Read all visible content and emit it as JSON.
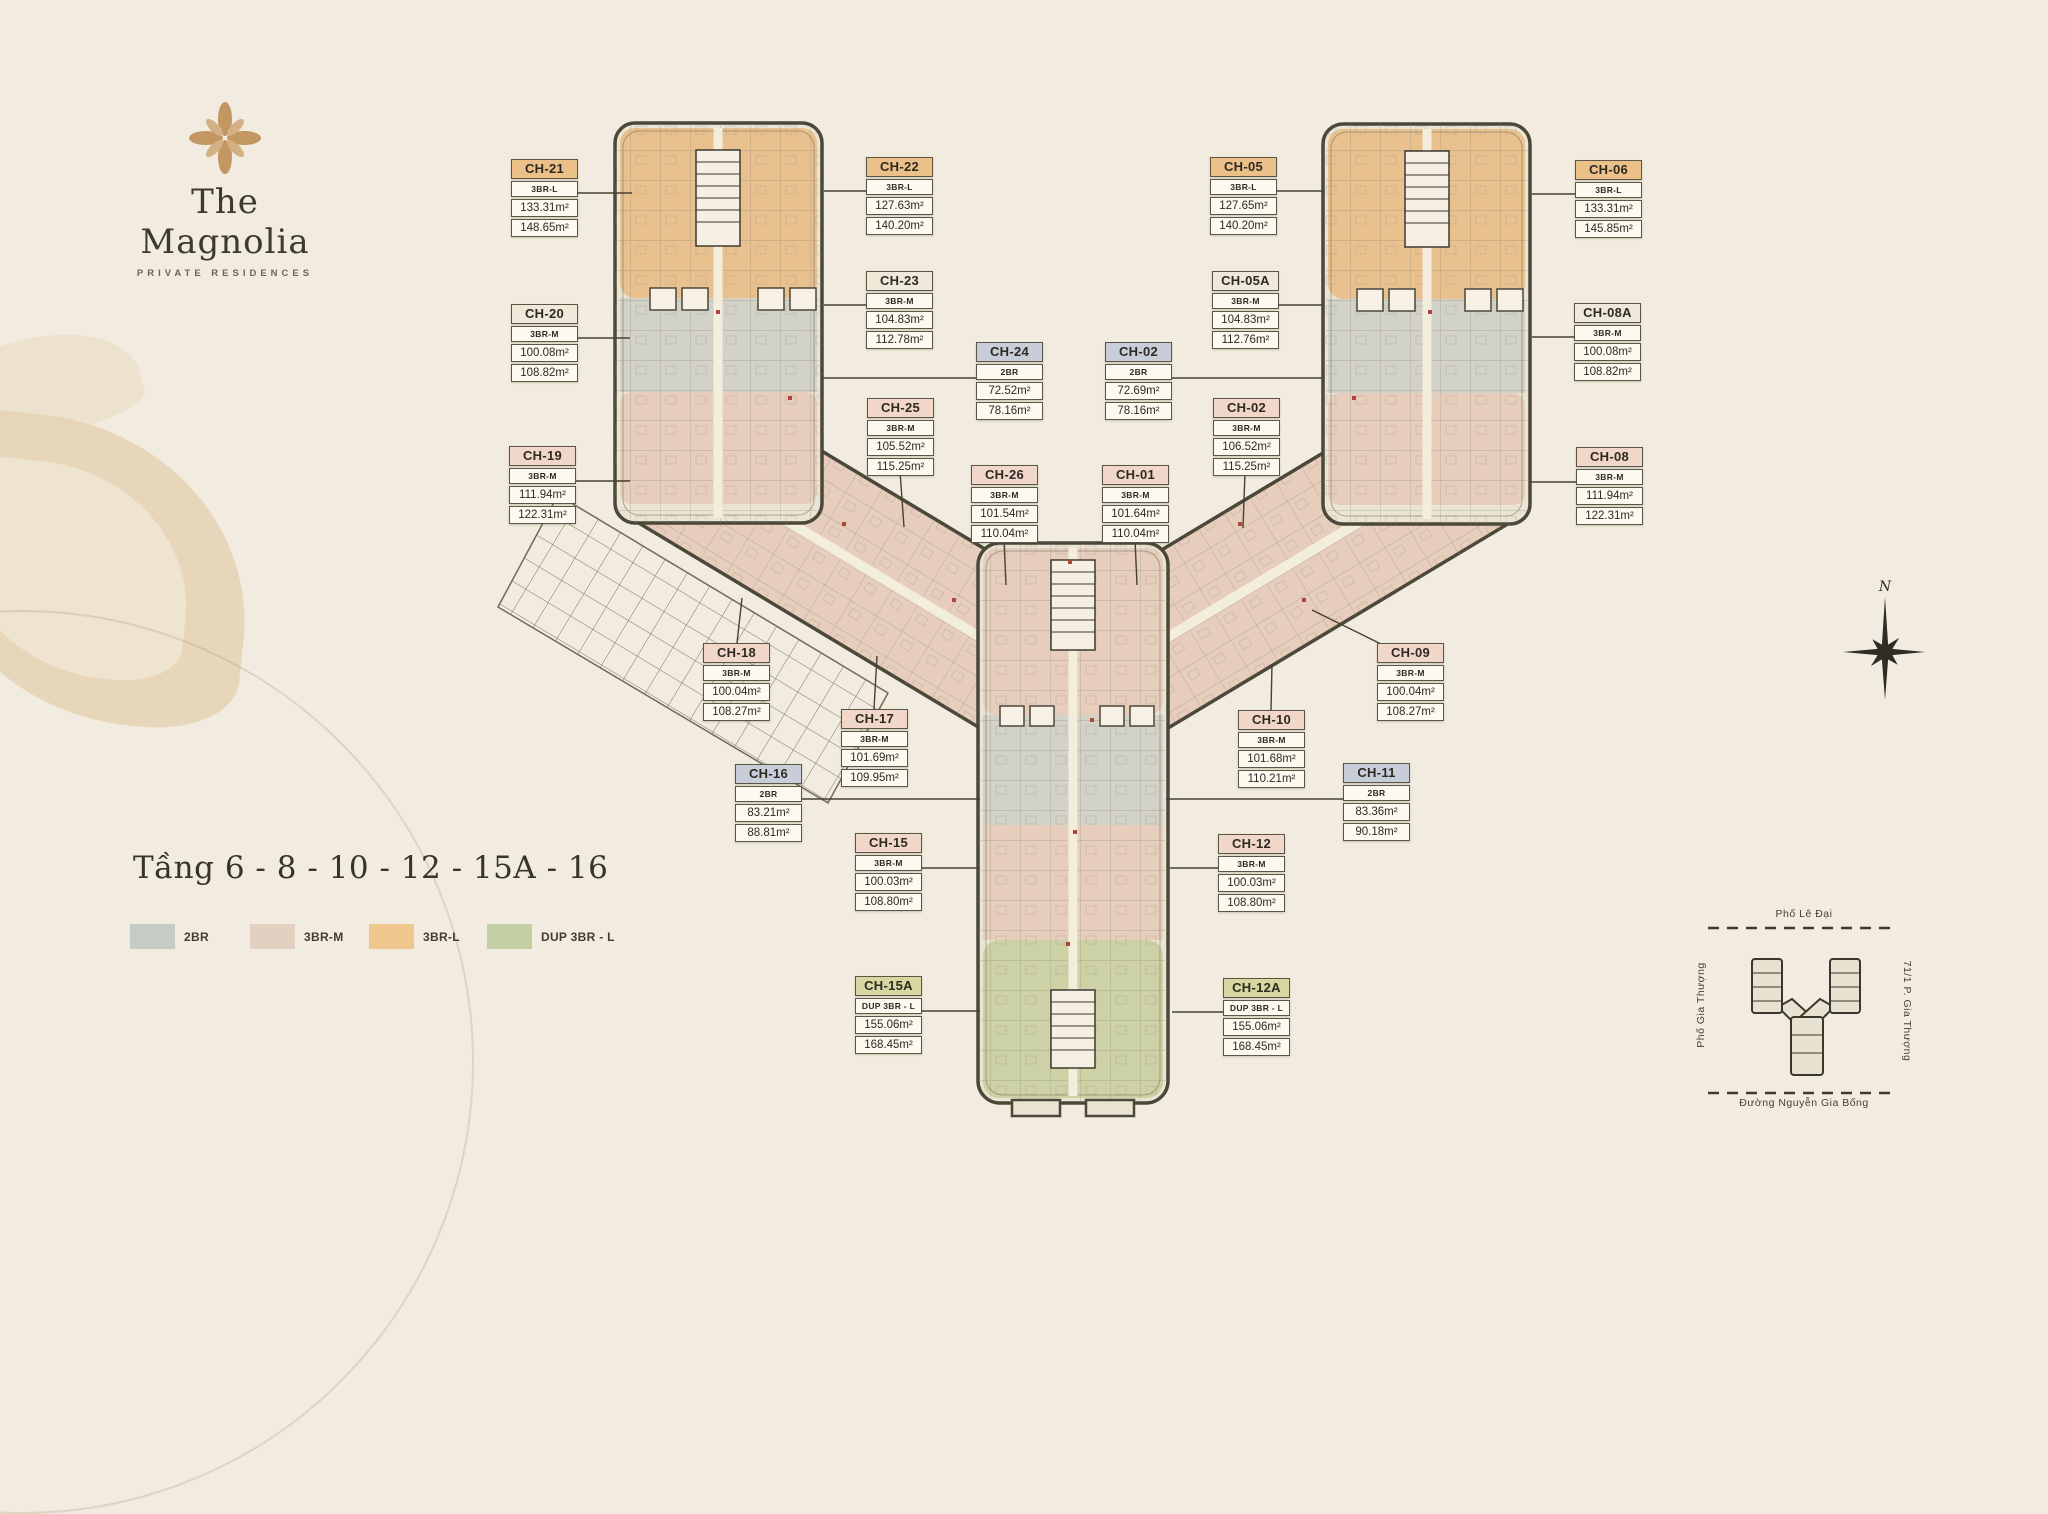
{
  "logo": {
    "icon": "magnolia-flower-icon",
    "title": "The Magnolia",
    "subtitle": "PRIVATE RESIDENCES"
  },
  "floor_title": "Tầng 6 - 8 - 10 - 12 - 15A - 16",
  "legend": [
    {
      "label": "2BR",
      "color": "#c5ccc5"
    },
    {
      "label": "3BR-M",
      "color": "#e3d0c1"
    },
    {
      "label": "3BR-L",
      "color": "#f0c88f"
    },
    {
      "label": "DUP 3BR - L",
      "color": "#c3cfa2"
    }
  ],
  "unit_colors": {
    "orange": "#ecc189",
    "pink": "#f1d7c9",
    "blue": "#c7cdd9",
    "green": "#d6d7a1",
    "neutral": "#efe9da"
  },
  "units": [
    {
      "id": "CH-21",
      "type": "3BR-L",
      "area1": "133.31m²",
      "area2": "148.65m²",
      "color": "orange",
      "x": 511,
      "y": 159,
      "leader": [
        578,
        193,
        632,
        193
      ]
    },
    {
      "id": "CH-20",
      "type": "3BR-M",
      "area1": "100.08m²",
      "area2": "108.82m²",
      "color": "neutral",
      "x": 511,
      "y": 304,
      "leader": [
        578,
        338,
        630,
        338
      ]
    },
    {
      "id": "CH-19",
      "type": "3BR-M",
      "area1": "111.94m²",
      "area2": "122.31m²",
      "color": "pink",
      "x": 509,
      "y": 446,
      "leader": [
        576,
        481,
        630,
        481
      ]
    },
    {
      "id": "CH-18",
      "type": "3BR-M",
      "area1": "100.04m²",
      "area2": "108.27m²",
      "color": "pink",
      "x": 703,
      "y": 643,
      "leader": [
        737,
        643,
        742,
        598
      ]
    },
    {
      "id": "CH-17",
      "type": "3BR-M",
      "area1": "101.69m²",
      "area2": "109.95m²",
      "color": "pink",
      "x": 841,
      "y": 709,
      "leader": [
        874,
        709,
        877,
        656
      ]
    },
    {
      "id": "CH-16",
      "type": "2BR",
      "area1": "83.21m²",
      "area2": "88.81m²",
      "color": "blue",
      "x": 735,
      "y": 764,
      "leader": [
        802,
        799,
        980,
        799
      ]
    },
    {
      "id": "CH-15",
      "type": "3BR-M",
      "area1": "100.03m²",
      "area2": "108.80m²",
      "color": "pink",
      "x": 855,
      "y": 833,
      "leader": [
        922,
        868,
        980,
        868
      ]
    },
    {
      "id": "CH-15A",
      "type": "DUP 3BR - L",
      "area1": "155.06m²",
      "area2": "168.45m²",
      "color": "green",
      "x": 855,
      "y": 976,
      "leader": [
        922,
        1011,
        980,
        1011
      ]
    },
    {
      "id": "CH-22",
      "type": "3BR-L",
      "area1": "127.63m²",
      "area2": "140.20m²",
      "color": "orange",
      "x": 866,
      "y": 157,
      "leader": [
        866,
        191,
        824,
        191
      ]
    },
    {
      "id": "CH-23",
      "type": "3BR-M",
      "area1": "104.83m²",
      "area2": "112.78m²",
      "color": "neutral",
      "x": 866,
      "y": 271,
      "leader": [
        866,
        305,
        824,
        305
      ]
    },
    {
      "id": "CH-24",
      "type": "2BR",
      "area1": "72.52m²",
      "area2": "78.16m²",
      "color": "blue",
      "x": 976,
      "y": 342,
      "leader": [
        976,
        378,
        823,
        378
      ]
    },
    {
      "id": "CH-25",
      "type": "3BR-M",
      "area1": "105.52m²",
      "area2": "115.25m²",
      "color": "pink",
      "x": 867,
      "y": 398,
      "leader": [
        900,
        471,
        904,
        527
      ]
    },
    {
      "id": "CH-26",
      "type": "3BR-M",
      "area1": "101.54m²",
      "area2": "110.04m²",
      "color": "pink",
      "x": 971,
      "y": 465,
      "leader": [
        1004,
        539,
        1006,
        585
      ]
    },
    {
      "id": "CH-02",
      "type": "2BR",
      "area1": "72.69m²",
      "area2": "78.16m²",
      "color": "blue",
      "x": 1105,
      "y": 342,
      "leader": [
        1172,
        378,
        1322,
        378
      ]
    },
    {
      "id": "CH-01",
      "type": "3BR-M",
      "area1": "101.64m²",
      "area2": "110.04m²",
      "color": "pink",
      "x": 1102,
      "y": 465,
      "leader": [
        1135,
        539,
        1137,
        585
      ]
    },
    {
      "id": "CH-05",
      "type": "3BR-L",
      "area1": "127.65m²",
      "area2": "140.20m²",
      "color": "orange",
      "x": 1210,
      "y": 157,
      "leader": [
        1277,
        191,
        1322,
        191
      ]
    },
    {
      "id": "CH-05A",
      "type": "3BR-M",
      "area1": "104.83m²",
      "area2": "112.76m²",
      "color": "neutral",
      "x": 1212,
      "y": 271,
      "leader": [
        1279,
        305,
        1322,
        305
      ]
    },
    {
      "id": "CH-02",
      "type": "3BR-M",
      "area1": "106.52m²",
      "area2": "115.25m²",
      "color": "pink",
      "x": 1213,
      "y": 398,
      "leader": [
        1245,
        472,
        1243,
        528
      ]
    },
    {
      "id": "CH-06",
      "type": "3BR-L",
      "area1": "133.31m²",
      "area2": "145.85m²",
      "color": "orange",
      "x": 1575,
      "y": 160,
      "leader": [
        1575,
        194,
        1532,
        194
      ]
    },
    {
      "id": "CH-08A",
      "type": "3BR-M",
      "area1": "100.08m²",
      "area2": "108.82m²",
      "color": "neutral",
      "x": 1574,
      "y": 303,
      "leader": [
        1574,
        337,
        1532,
        337
      ]
    },
    {
      "id": "CH-08",
      "type": "3BR-M",
      "area1": "111.94m²",
      "area2": "122.31m²",
      "color": "pink",
      "x": 1576,
      "y": 447,
      "leader": [
        1576,
        482,
        1530,
        482
      ]
    },
    {
      "id": "CH-09",
      "type": "3BR-M",
      "area1": "100.04m²",
      "area2": "108.27m²",
      "color": "pink",
      "x": 1377,
      "y": 643,
      "leader": [
        1383,
        645,
        1312,
        610
      ]
    },
    {
      "id": "CH-10",
      "type": "3BR-M",
      "area1": "101.68m²",
      "area2": "110.21m²",
      "color": "pink",
      "x": 1238,
      "y": 710,
      "leader": [
        1271,
        710,
        1272,
        664
      ]
    },
    {
      "id": "CH-11",
      "type": "2BR",
      "area1": "83.36m²",
      "area2": "90.18m²",
      "color": "blue",
      "x": 1343,
      "y": 763,
      "leader": [
        1343,
        799,
        1166,
        799
      ]
    },
    {
      "id": "CH-12",
      "type": "3BR-M",
      "area1": "100.03m²",
      "area2": "108.80m²",
      "color": "pink",
      "x": 1218,
      "y": 834,
      "leader": [
        1218,
        868,
        1170,
        868
      ]
    },
    {
      "id": "CH-12A",
      "type": "DUP 3BR - L",
      "area1": "155.06m²",
      "area2": "168.45m²",
      "color": "green",
      "x": 1223,
      "y": 978,
      "leader": [
        1223,
        1012,
        1172,
        1012
      ]
    }
  ],
  "compass": {
    "label": "N"
  },
  "minimap": {
    "street_top": "Phố Lê Đại",
    "street_left": "Phố Gia Thượng",
    "street_right": "71/1 P. Gia Thượng",
    "street_bottom": "Đường Nguyễn Gia Bống"
  }
}
